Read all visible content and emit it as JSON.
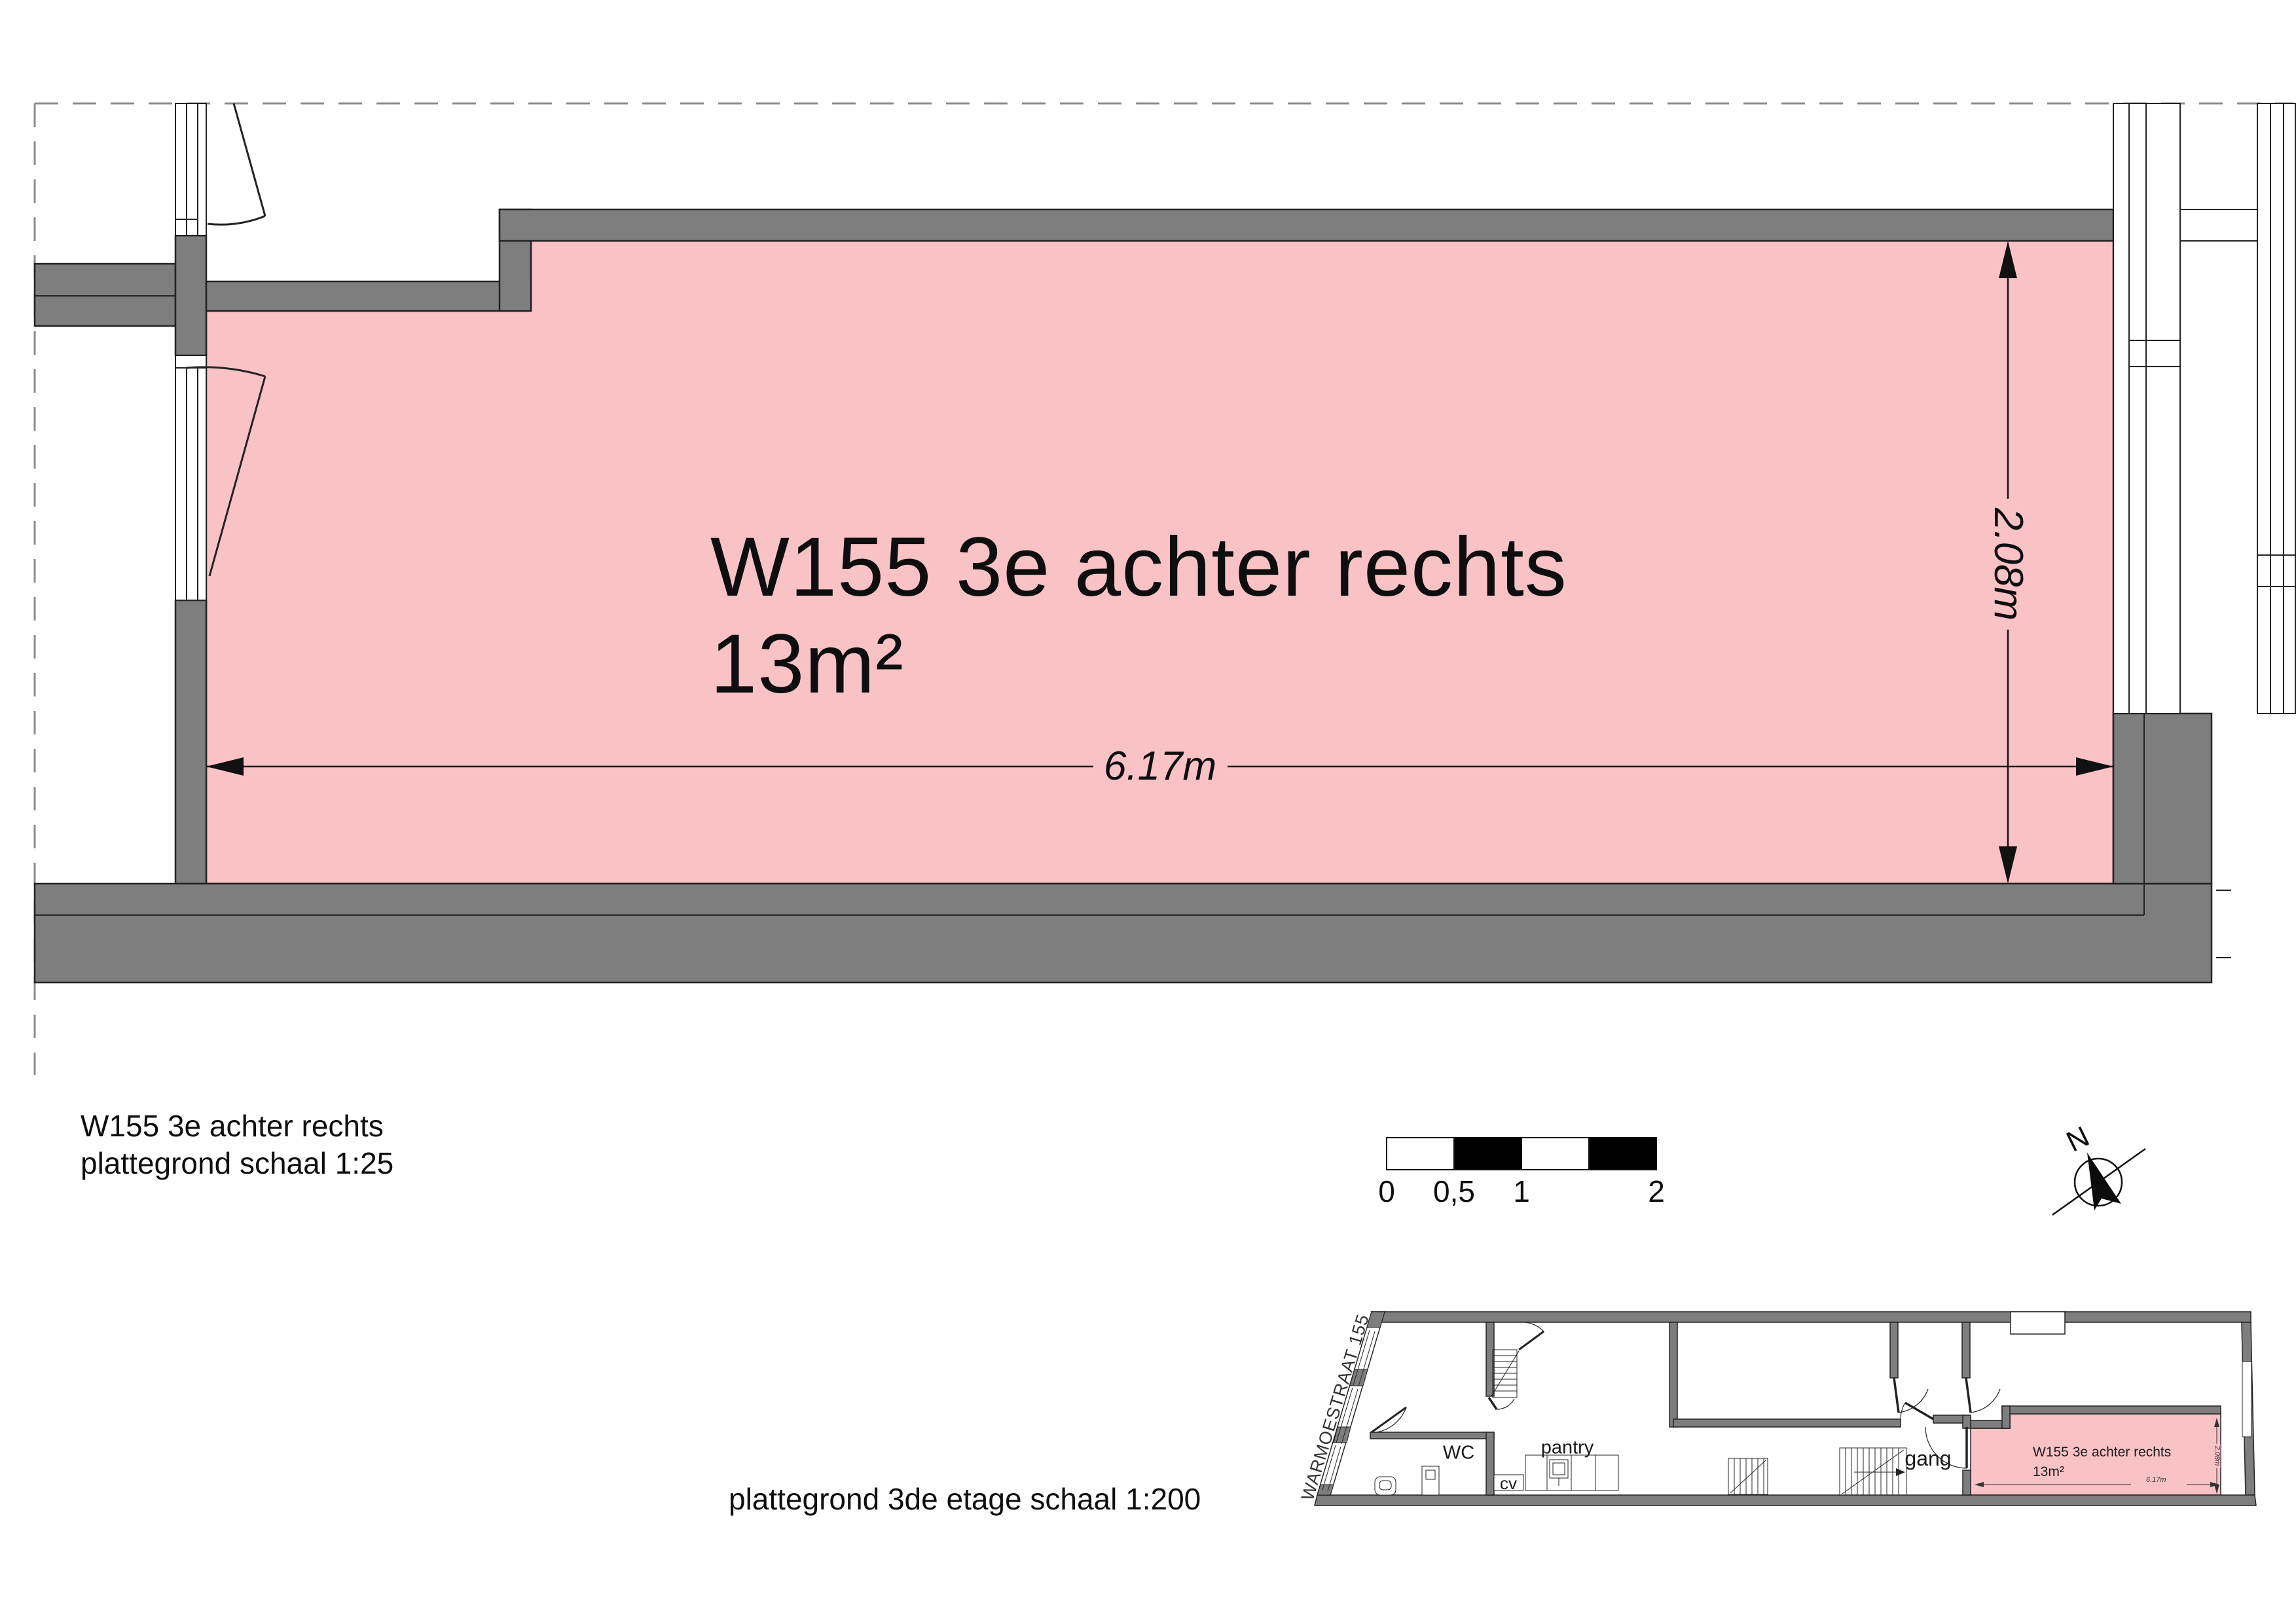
{
  "colors": {
    "wall_gray": "#7e7e7e",
    "room_pink": "#f9c2c5",
    "line": "#232323",
    "dashed": "#8c8c8c"
  },
  "main_plan": {
    "room_label_line1": "W155 3e achter rechts",
    "room_label_line2": "13m²",
    "dim_width": "6.17m",
    "dim_height": "2.08m"
  },
  "caption": {
    "line1": "W155 3e achter rechts",
    "line2": "plattegrond schaal 1:25"
  },
  "overview_caption": "plattegrond 3de etage schaal 1:200",
  "scale_bar": {
    "labels": [
      "0",
      "0,5",
      "1",
      "2"
    ]
  },
  "north_arrow": {
    "label": "N"
  },
  "overview_plan": {
    "street_label": "WARMOESTRAAT 155",
    "rooms": {
      "wc": "WC",
      "pantry": "pantry",
      "cv": "cv",
      "gang": "gang"
    },
    "highlight_label_line1": "W155 3e achter rechts",
    "highlight_label_line2": "13m²",
    "dim_width": "6.17m",
    "dim_height": "2.08m"
  }
}
